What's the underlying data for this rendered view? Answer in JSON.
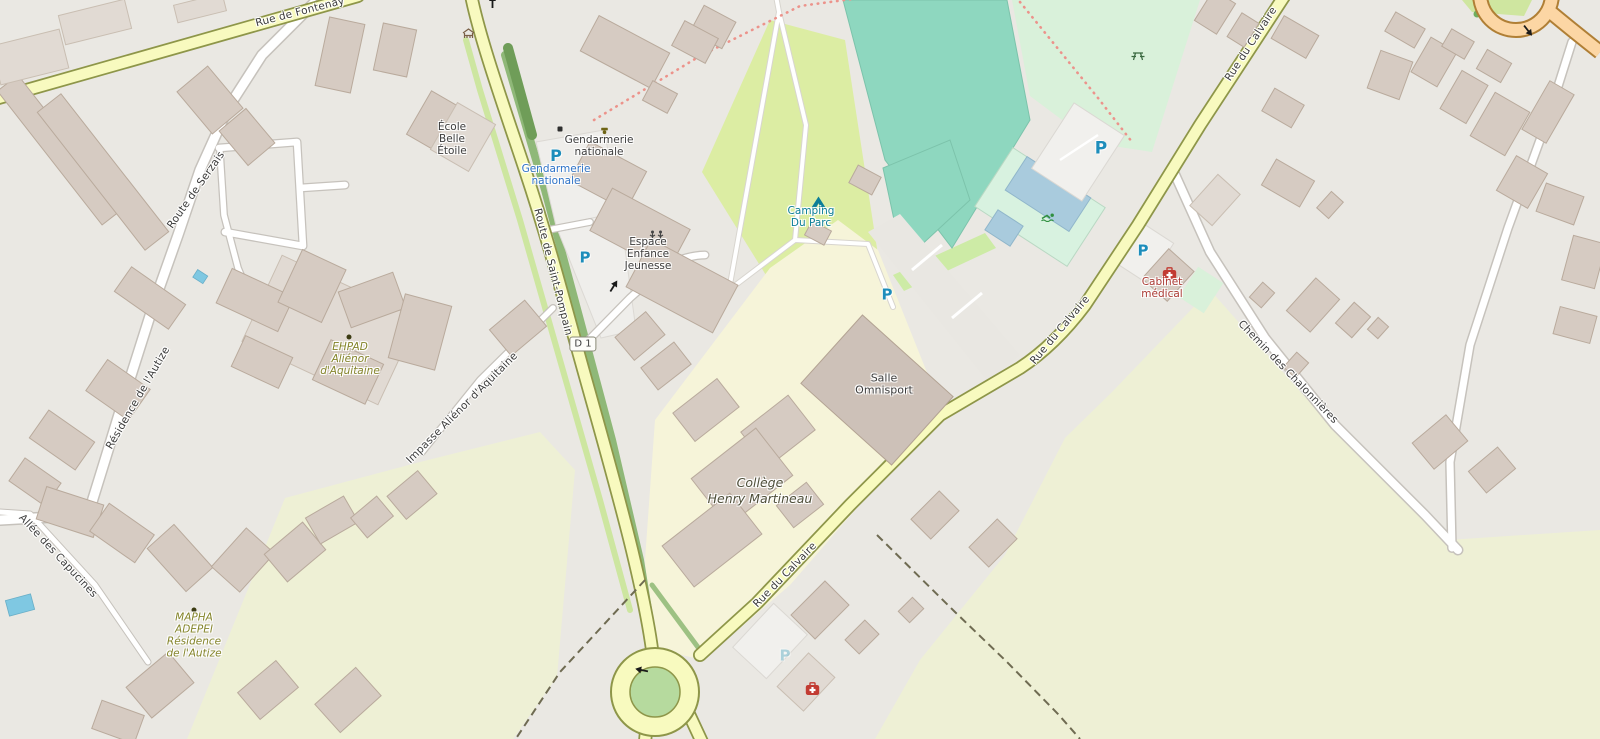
{
  "map": {
    "roads": {
      "labels": [
        {
          "name": "Rue de Fontenay"
        },
        {
          "name": "Route de Serzais"
        },
        {
          "name": "Route de Saint-Pompain"
        },
        {
          "name": "Résidence de l'Autize"
        },
        {
          "name": "Impasse Aliénor d'Aquitaine"
        },
        {
          "name": "Allée des Capucines"
        },
        {
          "name": "Rue du Calvaire"
        },
        {
          "name": "Rue du Calvaire"
        },
        {
          "name": "Rue du Calvaire"
        },
        {
          "name": "Chemin des Chalonnières"
        }
      ],
      "route_badge": "D 1"
    },
    "pois": {
      "ecole": {
        "lines": [
          "École",
          "Belle",
          "Étoile"
        ]
      },
      "gendarmerie": {
        "lines": [
          "Gendarmerie",
          "nationale"
        ]
      },
      "gendarmerie_parking": {
        "lines": [
          "Gendarmerie",
          "nationale"
        ]
      },
      "espace": {
        "lines": [
          "Espace",
          "Enfance",
          "Jeunesse"
        ]
      },
      "camping": {
        "lines": [
          "Camping",
          "Du Parc"
        ]
      },
      "salle": {
        "lines": [
          "Salle",
          "Omnisport"
        ]
      },
      "college": {
        "lines": [
          "Collège",
          "Henry Martineau"
        ]
      },
      "ehpad": {
        "lines": [
          "EHPAD",
          "Aliénor",
          "d'Aquitaine"
        ]
      },
      "mapha": {
        "lines": [
          "MAPHA",
          "ADEPEI",
          "Résidence",
          "de l'Autize"
        ]
      },
      "cabinet": {
        "lines": [
          "Cabinet",
          "médical"
        ]
      }
    },
    "symbols": {
      "parking": "P"
    },
    "colors": {
      "bg": "#eae8e3",
      "label-dark": "#3c3c3c",
      "label-blue": "#2e73c8",
      "label-teal": "#0c7e98",
      "label-red": "#ac3b35",
      "label-olive": "#84842a",
      "parking": "#1d8dbb",
      "road-yellow": "#f8fabf",
      "road-orange": "#fcd6a4",
      "pitch": "#8ed7bf",
      "park": "#d9f1da",
      "camping": "#dceda3",
      "school": "#f6f4d9",
      "farmland": "#eef0d5",
      "water": "#a9cbdd",
      "building": "#d6cbc2",
      "medical-red": "#c23b32"
    }
  }
}
